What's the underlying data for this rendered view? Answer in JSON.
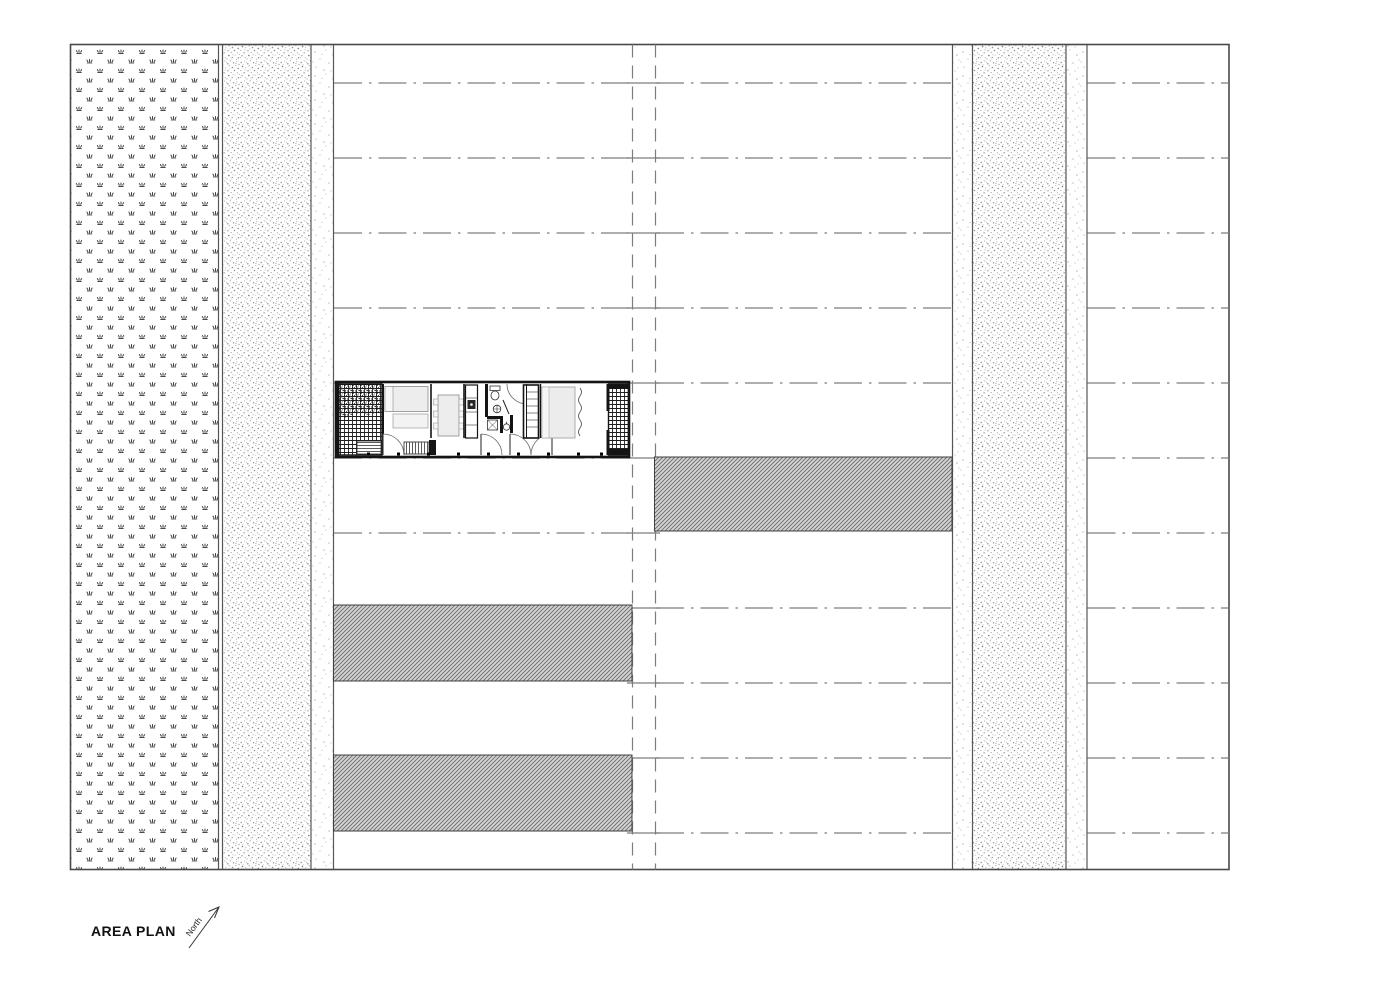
{
  "page": {
    "background": "#ffffff"
  },
  "labels": {
    "title": "AREA PLAN",
    "north": "North"
  },
  "colors": {
    "ink": "#141414",
    "line_gray": "#7d7d7d",
    "border_gray": "#565656",
    "hatch_fill": "#d4d4d4",
    "hatch_line": "#696969",
    "furniture_fill": "#ededed",
    "paper": "#ffffff"
  },
  "drawing": {
    "bands_left_to_right": [
      {
        "name": "planting-strip",
        "texture": "grass-symbol-field"
      },
      {
        "name": "gravel-strip-west",
        "texture": "dense-stipple"
      },
      {
        "name": "walk-strip-west",
        "texture": "sparse-stipple"
      },
      {
        "name": "lot-column-west",
        "texture": "plain",
        "lot_lines": "dash-dot"
      },
      {
        "name": "center-lane",
        "texture": "double-dashed-line"
      },
      {
        "name": "lot-column-center",
        "texture": "plain",
        "lot_lines": "dash-dot"
      },
      {
        "name": "walk-strip-east-inner",
        "texture": "sparse-stipple"
      },
      {
        "name": "gravel-strip-east",
        "texture": "dense-stipple"
      },
      {
        "name": "walk-strip-east-outer",
        "texture": "sparse-stipple"
      },
      {
        "name": "lot-column-east",
        "texture": "plain",
        "lot_lines": "dash-dot"
      }
    ],
    "lot_row_count": 11,
    "hatched_footprints": [
      {
        "name": "footprint-center-column",
        "column": "center",
        "row": 6
      },
      {
        "name": "footprint-west-column-upper",
        "column": "west",
        "row": 8
      },
      {
        "name": "footprint-west-column-lower",
        "column": "west",
        "row": 10
      }
    ],
    "unit_plan": {
      "name": "dwelling-unit-floor-plan",
      "column": "west",
      "row": 5,
      "features": [
        "entry-deck",
        "planting",
        "bedroom",
        "dining",
        "kitchen",
        "bathroom",
        "laundry",
        "closet",
        "bedroom-2",
        "rear-deck",
        "door-swings",
        "curtain"
      ]
    }
  }
}
